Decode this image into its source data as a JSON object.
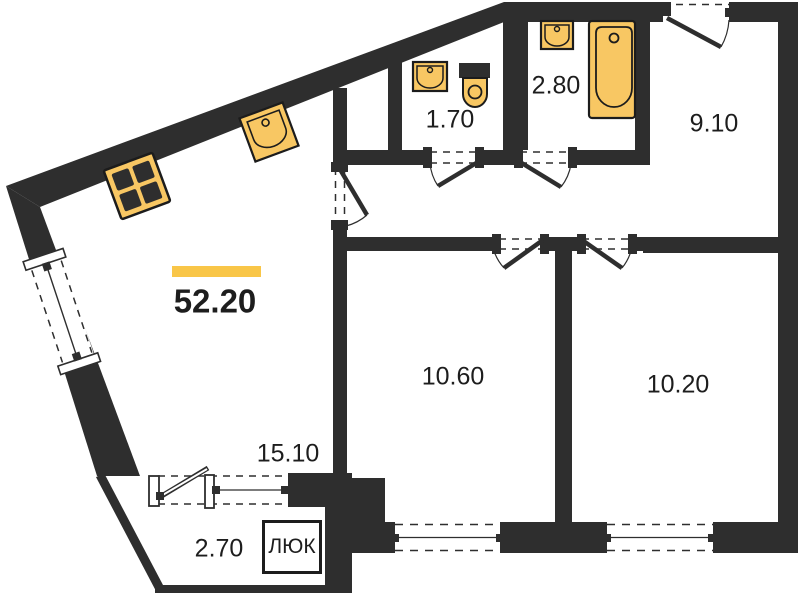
{
  "floorplan": {
    "total_area": {
      "value": "52.20"
    },
    "rooms": [
      {
        "name": "living-kitchen",
        "area": "15.10"
      },
      {
        "name": "wc",
        "area": "1.70"
      },
      {
        "name": "bathroom",
        "area": "2.80"
      },
      {
        "name": "hallway",
        "area": "9.10"
      },
      {
        "name": "bedroom-left",
        "area": "10.60"
      },
      {
        "name": "bedroom-right",
        "area": "10.20"
      },
      {
        "name": "balcony",
        "area": "2.70"
      }
    ],
    "hatch": {
      "label": "ЛЮК"
    },
    "colors": {
      "wall": "#2e2e2e",
      "fixture_fill": "#F8C763",
      "fixture_stroke": "#1c1c1c",
      "accent_bar": "#F9C648",
      "background": "#ffffff"
    },
    "fixtures": [
      "stove-icon",
      "kitchen-sink-icon",
      "wc-sink-icon",
      "toilet-icon",
      "bath-sink-icon",
      "bathtub-icon"
    ]
  }
}
